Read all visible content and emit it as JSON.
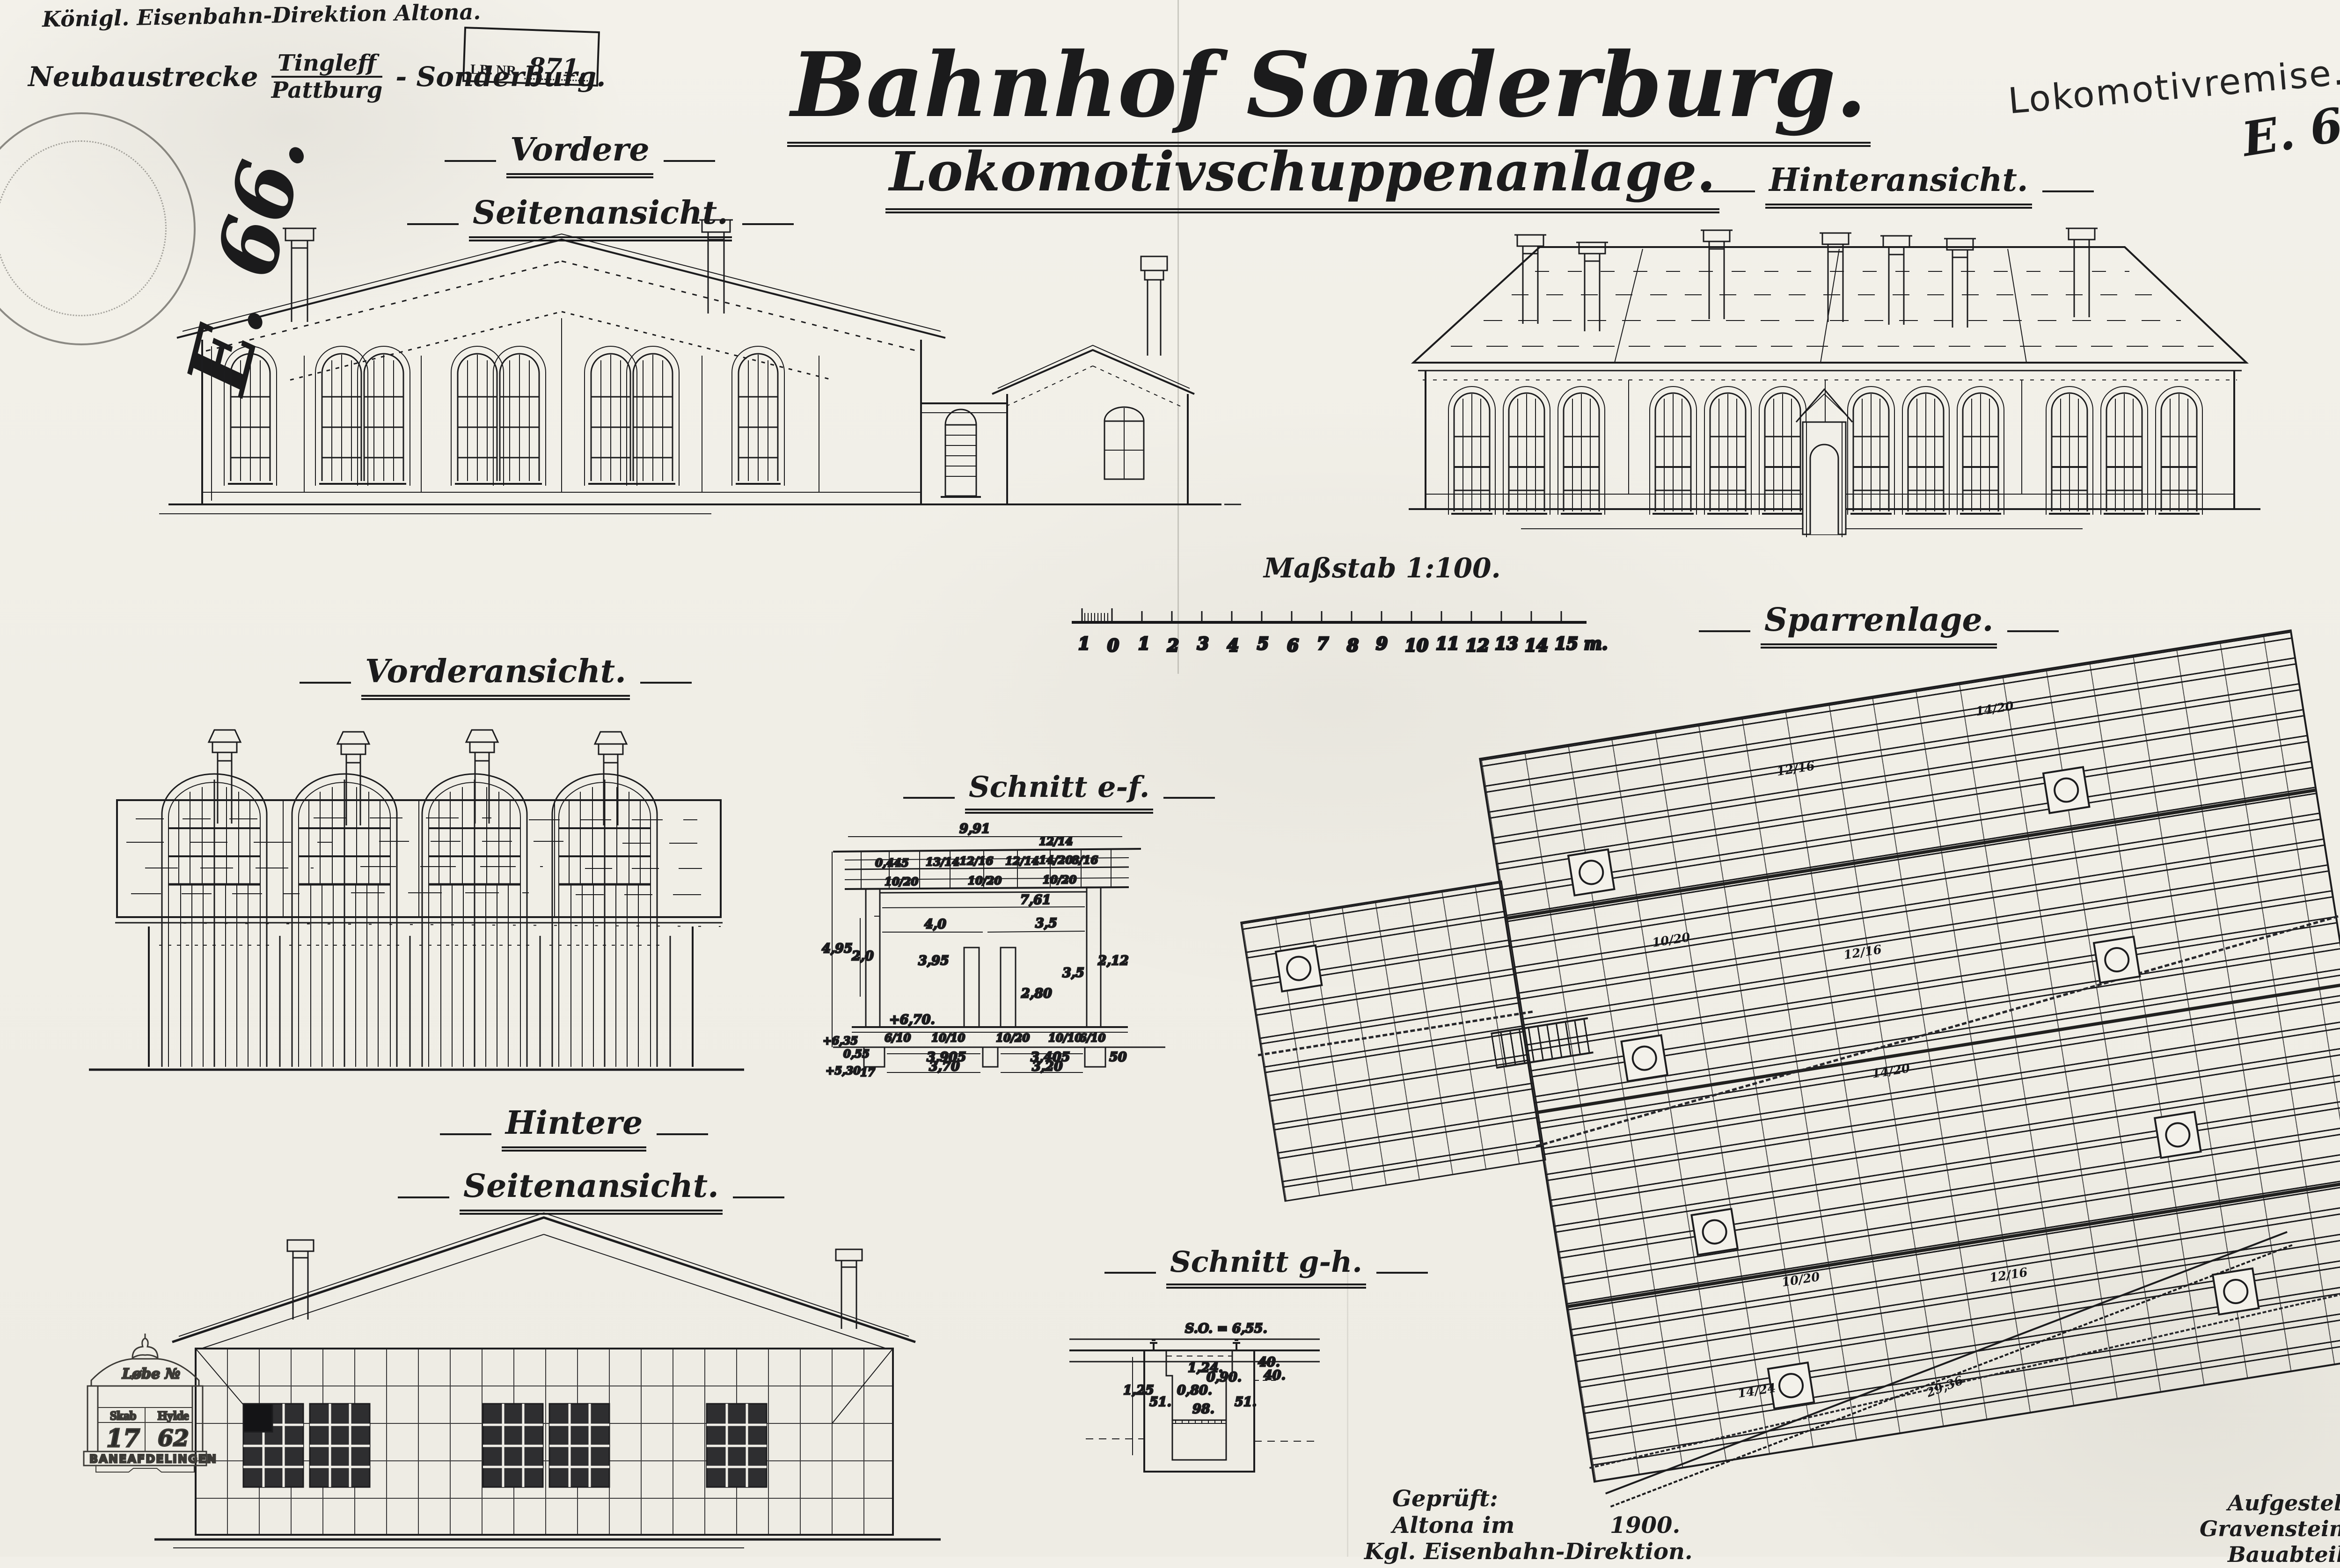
{
  "colors": {
    "ink": "#1c1c1e",
    "paper": "#f1efe8",
    "faint_stamp": "#8a8a85"
  },
  "header": {
    "authority": "Königl. Eisenbahn-Direktion Altona.",
    "route_prefix": "Neubaustrecke",
    "route_top": "Tingleff",
    "route_bottom": "Pattburg",
    "route_suffix": "- Sonderburg.",
    "lb_label": "LB. NR.",
    "lb_number": "871.",
    "file_code": "E. 66.",
    "remise_note": "Lokomotivremise.",
    "file_code_right": "E. 66."
  },
  "title": {
    "main": "Bahnhof Sonderburg.",
    "sub": "Lokomotivschuppenanlage."
  },
  "views": {
    "vordere_1": "Vordere",
    "vordere_2": "Seitenansicht.",
    "hinteransicht": "Hinteransicht.",
    "vorderansicht": "Vorderansicht.",
    "schnitt_ef": "Schnitt e-f.",
    "sparrenlage": "Sparrenlage.",
    "hintere_1": "Hintere",
    "hintere_2": "Seitenansicht.",
    "schnitt_gh": "Schnitt g-h."
  },
  "scalebar": {
    "label": "Maßstab 1:100.",
    "ticks": [
      "1",
      "0",
      "1",
      "2",
      "3",
      "4",
      "5",
      "6",
      "7",
      "8",
      "9",
      "10",
      "11",
      "12",
      "13",
      "14",
      "15 m."
    ]
  },
  "ef_dims": [
    "9,91",
    "4,95",
    "2,0",
    "0,445",
    "13/14",
    "12/16",
    "12/14",
    "14/20",
    "8/16",
    "12/14",
    "10/20",
    "10/20",
    "10/20",
    "7,61",
    "4,0",
    "3,5",
    "3,95",
    "2,80",
    "3,5",
    "2,12",
    "+6,70.",
    "6/10",
    "10/10",
    "10/20",
    "10/10",
    "6/10",
    "3,905",
    "3,405",
    "50",
    "3,70",
    "3,20",
    "0,55",
    "17",
    "+5,30",
    "+6,35"
  ],
  "gh_dims": [
    "S.O. = 6,55.",
    "1,24.",
    "0,90.",
    "0,80.",
    "1,25",
    "51.",
    "51.",
    "98.",
    "40.",
    "40."
  ],
  "sparren": {
    "notes": [
      "12/16",
      "14/20",
      "10/20",
      "12/16",
      "14/20",
      "10/20",
      "12/16",
      "14/24"
    ],
    "edge_dim": "29,36"
  },
  "signoff_checked": {
    "l1": "Geprüft:",
    "l2a": "Altona im",
    "l2b": "1900.",
    "l3": "Kgl. Eisenbahn-Direktion."
  },
  "signoff_prepared": {
    "l1": "Aufgestellt:",
    "l2": "Gravenstein, im Febr. 1900.",
    "l3": "Bauabteilung."
  },
  "archive_stamp": {
    "top": "Løbe №",
    "skab": "Skab",
    "hylde": "Hylde",
    "skab_no": "17",
    "hylde_no": "62",
    "footer": "BANEAFDELINGEN"
  }
}
